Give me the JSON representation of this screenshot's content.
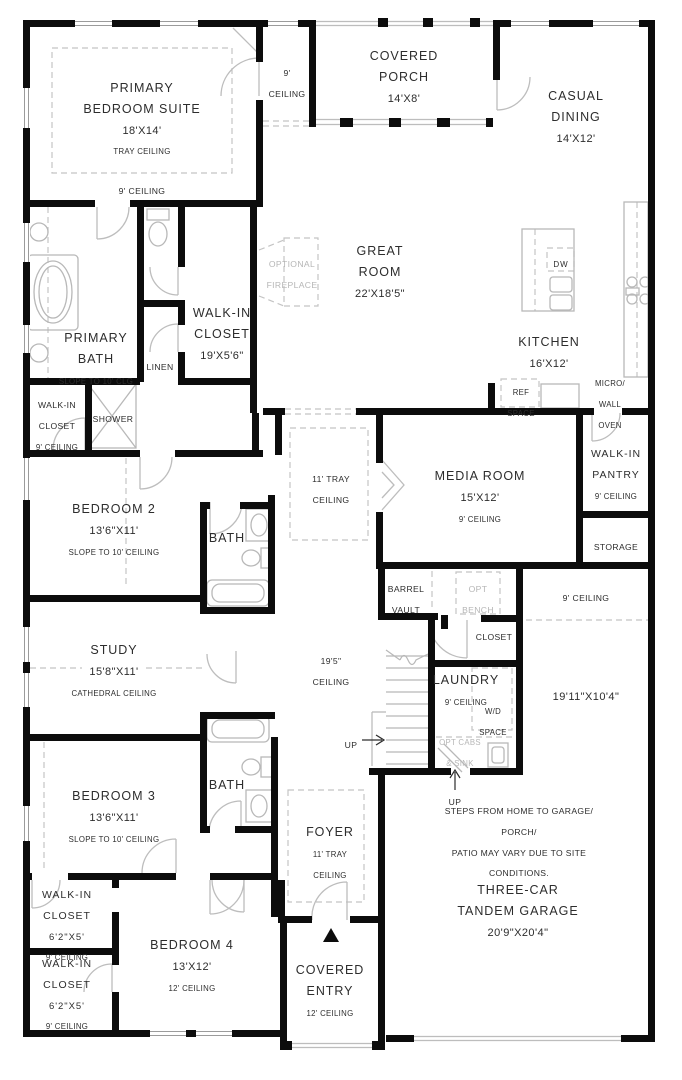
{
  "labels": {
    "primary_bedroom": {
      "name": "PRIMARY\nBEDROOM SUITE",
      "dims": "18'X14'",
      "note": "TRAY CEILING"
    },
    "primary_ceiling": {
      "note": "9' CEILING"
    },
    "vestibule": {
      "note": "9'\nCEILING"
    },
    "covered_porch": {
      "name": "COVERED\nPORCH",
      "dims": "14'X8'"
    },
    "casual_dining": {
      "name": "CASUAL\nDINING",
      "dims": "14'X12'"
    },
    "great_room": {
      "name": "GREAT\nROOM",
      "dims": "22'X18'5\""
    },
    "optional_fireplace": {
      "note": "OPTIONAL\nFIREPLACE"
    },
    "kitchen": {
      "name": "KITCHEN",
      "dims": "16'X12'"
    },
    "dw": {
      "note": "DW"
    },
    "micro_wall_oven": {
      "note": "MICRO/\nWALL\nOVEN"
    },
    "ref_space": {
      "note": "REF\nSPACE"
    },
    "primary_bath": {
      "name": "PRIMARY\nBATH",
      "note": "SLOPE TO 10' CLG"
    },
    "wic_primary": {
      "name": "WALK-IN\nCLOSET",
      "dims": "19'X5'6\""
    },
    "linen": {
      "note": "LINEN"
    },
    "wic_hall": {
      "name": "WALK-IN\nCLOSET",
      "note": "9' CEILING"
    },
    "shower": {
      "note": "SHOWER"
    },
    "bedroom2": {
      "name": "BEDROOM 2",
      "dims": "13'6\"X11'",
      "note": "SLOPE TO 10' CEILING"
    },
    "bath2": {
      "name": "BATH"
    },
    "hall_tray": {
      "note": "11' TRAY\nCEILING"
    },
    "media_room": {
      "name": "MEDIA ROOM",
      "dims": "15'X12'",
      "note": "9' CEILING"
    },
    "pantry": {
      "name": "WALK-IN\nPANTRY",
      "note": "9' CEILING"
    },
    "storage": {
      "note": "STORAGE"
    },
    "barrel_vault": {
      "note": "BARREL\nVAULT"
    },
    "opt_bench": {
      "note": "OPT\nBENCH"
    },
    "hall9": {
      "note": "9' CEILING"
    },
    "closet_hall": {
      "note": "CLOSET"
    },
    "study": {
      "name": "STUDY",
      "dims": "15'8\"X11'",
      "note": "CATHEDRAL CEILING"
    },
    "ceiling195": {
      "note": "19'5\"\nCEILING"
    },
    "laundry": {
      "name": "LAUNDRY",
      "note": "9' CEILING"
    },
    "wd_space": {
      "note": "W/D\nSPACE"
    },
    "opt_cabs": {
      "note": "OPT CABS\n& SINK"
    },
    "up_left": {
      "note": "UP"
    },
    "up_bottom": {
      "note": "UP"
    },
    "steps_note": {
      "note": "STEPS FROM HOME TO GARAGE/ PORCH/\nPATIO MAY VARY DUE TO SITE CONDITIONS."
    },
    "tandem_dims": {
      "dims": "19'11\"X10'4\""
    },
    "bedroom3": {
      "name": "BEDROOM 3",
      "dims": "13'6\"X11'",
      "note": "SLOPE TO 10' CEILING"
    },
    "bath3": {
      "name": "BATH"
    },
    "foyer": {
      "name": "FOYER",
      "note": "11' TRAY\nCEILING"
    },
    "wic_closet_a": {
      "name": "WALK-IN\nCLOSET",
      "dims": "6'2\"X5'",
      "note": "9' CEILING"
    },
    "wic_closet_b": {
      "name": "WALK-IN\nCLOSET",
      "dims": "6'2\"X5'",
      "note": "9' CEILING"
    },
    "bedroom4": {
      "name": "BEDROOM 4",
      "dims": "13'X12'",
      "note": "12' CEILING"
    },
    "covered_entry": {
      "name": "COVERED\nENTRY",
      "note": "12' CEILING"
    },
    "garage": {
      "name": "THREE-CAR\nTANDEM GARAGE",
      "dims": "20'9\"X20'4\""
    }
  },
  "colors": {
    "wall": "#0c0c0c",
    "fixture": "#b8b8b8",
    "dashed": "#c4c4c4",
    "text": "#2d2d2d",
    "optional_text": "#b6b6b6",
    "background": "#ffffff"
  }
}
